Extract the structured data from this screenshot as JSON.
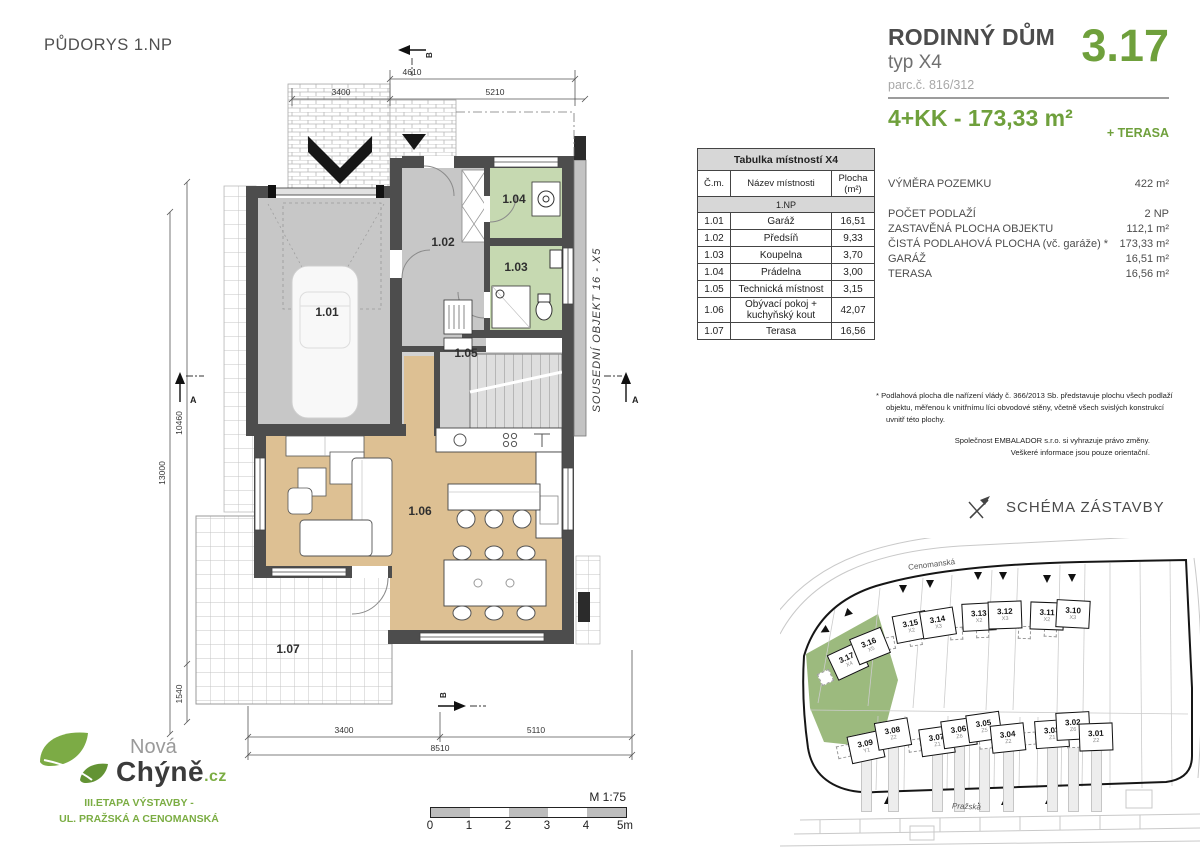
{
  "accent": "#6fa03c",
  "logo_green": "#7bad43",
  "page_title": "PŮDORYS 1.NP",
  "header": {
    "title": "RODINNÝ DŮM",
    "unit_number": "3.17",
    "type": "typ X4",
    "parcel": "parc.č. 816/312",
    "disposition": "4+KK - 173,33 m²",
    "terrace_suffix": "+ TERASA"
  },
  "details": {
    "rows": [
      {
        "label": "VÝMĚRA POZEMKU",
        "value": "422 m²",
        "gap_after": true
      },
      {
        "label": "POČET PODLAŽÍ",
        "value": "2 NP"
      },
      {
        "label": "ZASTAVĚNÁ PLOCHA OBJEKTU",
        "value": "112,1 m²"
      },
      {
        "label": "ČISTÁ PODLAHOVÁ PLOCHA (vč. garáže) *",
        "value": "173,33 m²"
      },
      {
        "label": "GARÁŽ",
        "value": "16,51 m²"
      },
      {
        "label": "TERASA",
        "value": "16,56 m²"
      }
    ]
  },
  "room_table": {
    "title": "Tabulka místností X4",
    "col_num": "Č.m.",
    "col_name": "Název místnosti",
    "col_area1": "Plocha",
    "col_area2": "(m²)",
    "section": "1.NP",
    "rows": [
      {
        "num": "1.01",
        "name": "Garáž",
        "area": "16,51"
      },
      {
        "num": "1.02",
        "name": "Předsíň",
        "area": "9,33"
      },
      {
        "num": "1.03",
        "name": "Koupelna",
        "area": "3,70"
      },
      {
        "num": "1.04",
        "name": "Prádelna",
        "area": "3,00"
      },
      {
        "num": "1.05",
        "name": "Technická místnost",
        "area": "3,15"
      },
      {
        "num": "1.06",
        "name": "Obývací pokoj + kuchyňský kout",
        "area": "42,07"
      },
      {
        "num": "1.07",
        "name": "Terasa",
        "area": "16,56"
      }
    ]
  },
  "notes": {
    "asterisk": "* Podlahová plocha dle nařízení vlády č. 366/2013 Sb. představuje plochu všech podlaží objektu, měřenou k vnitřnímu líci obvodové stěny, včetně všech svislých konstrukcí uvnitř této plochy.",
    "company_line1": "Společnost EMBALADOR s.r.o. si vyhrazuje právo změny.",
    "company_line2": "Veškeré informace jsou pouze orientační."
  },
  "schema": {
    "title": "SCHÉMA ZÁSTAVBY",
    "street_top": "Cenomanská",
    "street_bottom": "Pražská",
    "plots_top": [
      {
        "num": "3.17",
        "type": "X4",
        "highlight": true
      },
      {
        "num": "3.16",
        "type": "X5"
      },
      {
        "num": "3.15",
        "type": "X2"
      },
      {
        "num": "3.14",
        "type": "X3"
      },
      {
        "num": "3.13",
        "type": "X2"
      },
      {
        "num": "3.12",
        "type": "X3"
      },
      {
        "num": "3.11",
        "type": "X2"
      },
      {
        "num": "3.10",
        "type": "X3"
      }
    ],
    "plots_bottom": [
      {
        "num": "3.09",
        "type": "Y1"
      },
      {
        "num": "3.08",
        "type": "Z2"
      },
      {
        "num": "3.07",
        "type": "Z1"
      },
      {
        "num": "3.06",
        "type": "Z6"
      },
      {
        "num": "3.05",
        "type": "Z5"
      },
      {
        "num": "3.04",
        "type": "Z2"
      },
      {
        "num": "3.03",
        "type": "Z1"
      },
      {
        "num": "3.02",
        "type": "Z6"
      },
      {
        "num": "3.01",
        "type": "Z2"
      }
    ]
  },
  "logo": {
    "name_top": "Nová",
    "name_main": "Chýně",
    "name_suffix": ".cz",
    "etapa_line1": "III.ETAPA VÝSTAVBY -",
    "etapa_line2": "UL. PRAŽSKÁ A CENOMANSKÁ"
  },
  "scale_bar": {
    "scale": "M 1:75",
    "ticks": [
      "0",
      "1",
      "2",
      "3",
      "4",
      "5m"
    ]
  },
  "plan": {
    "rooms": {
      "r101": "1.01",
      "r102": "1.02",
      "r103": "1.03",
      "r104": "1.04",
      "r105": "1.05",
      "r106": "1.06",
      "r107": "1.07"
    },
    "neighbor": "SOUSEDNÍ OBJEKT 16 - X5",
    "dims": {
      "top_inner": "4610",
      "top_left": "3400",
      "top_right": "5210",
      "left_total": "13000",
      "left_main": "10460",
      "left_low": "1540",
      "bottom_left": "3400",
      "bottom_right": "5110",
      "bottom_total": "8510"
    },
    "markers": {
      "a": "A",
      "b": "B"
    }
  }
}
